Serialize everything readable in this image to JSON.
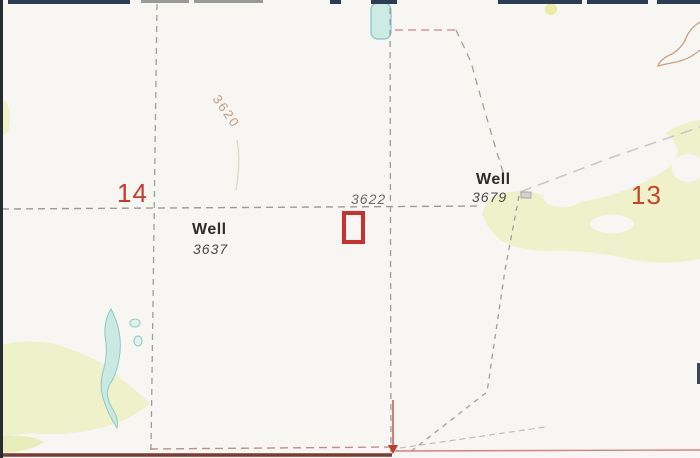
{
  "map": {
    "section_labels": [
      {
        "number": "14"
      },
      {
        "number": "13"
      }
    ],
    "wells": [
      {
        "label": "Well",
        "elevation": "3637"
      },
      {
        "label": "Well",
        "elevation": "3679"
      }
    ],
    "spot_elevation": "3622",
    "contour_label": "3620",
    "colors": {
      "background": "#f7f6f3",
      "section_number_red": "#c23b2e",
      "marker_red": "#c93030",
      "survey_red": "#cc4444",
      "dark_boundary_red": "#7a3b33",
      "dashed_line_gray": "#9e9e9e",
      "water_fill": "#cdeae4",
      "water_stroke": "#84c3cc",
      "vegetation": "#eef1c9",
      "contour_brown": "#c9a183"
    }
  }
}
